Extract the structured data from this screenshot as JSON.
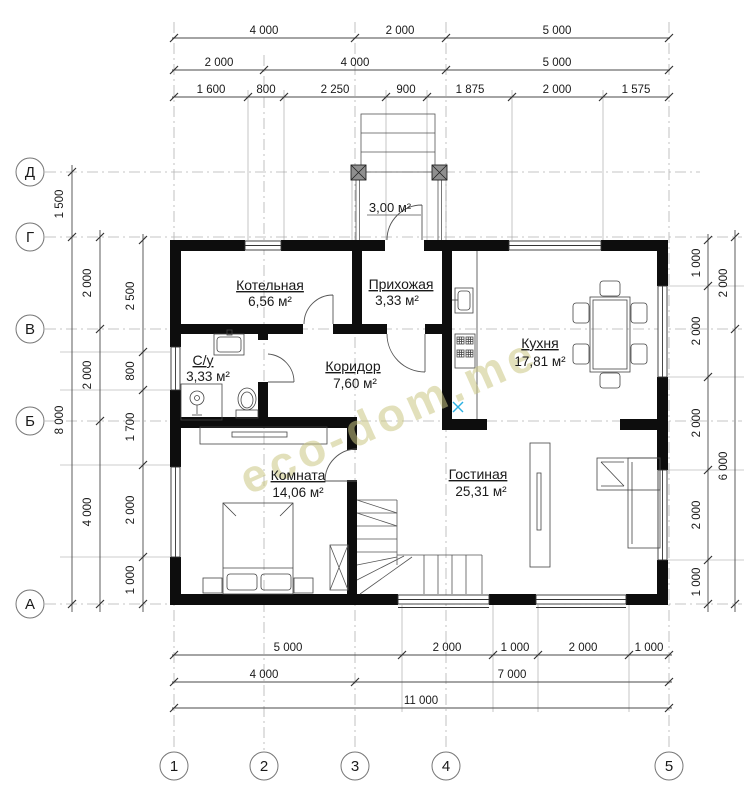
{
  "watermark": {
    "text": "eco-dom.me"
  },
  "axis_labels": {
    "rows": [
      "Д",
      "Г",
      "В",
      "Б",
      "А"
    ],
    "cols": [
      "1",
      "2",
      "3",
      "4",
      "5"
    ]
  },
  "rooms": [
    {
      "name": "Котельная",
      "area": "6,56 м²"
    },
    {
      "name": "Прихожая",
      "area": "3,33 м²"
    },
    {
      "name": "Кухня",
      "area": "17,81 м²"
    },
    {
      "name": "С/у",
      "area": "3,33 м²"
    },
    {
      "name": "Коридор",
      "area": "7,60 м²"
    },
    {
      "name": "Комната",
      "area": "14,06 м²"
    },
    {
      "name": "Гостиная",
      "area": "25,31 м²"
    }
  ],
  "porch": {
    "area": "3,00 м²"
  },
  "dimensions": {
    "top_row1": [
      "4 000",
      "2 000",
      "5 000"
    ],
    "top_row2": [
      "2 000",
      "4 000",
      "5 000"
    ],
    "top_row3": [
      "1 600",
      "800",
      "2 250",
      "900",
      "1 875",
      "2 000",
      "1 575"
    ],
    "bottom_row1": [
      "5 000",
      "2 000",
      "1 000",
      "2 000",
      "1 000"
    ],
    "bottom_row2": [
      "4 000",
      "7 000"
    ],
    "bottom_row3": [
      "11 000"
    ],
    "left_outer": [
      "1 500",
      "8 000"
    ],
    "left_middle": [
      "2 000",
      "2 000",
      "4 000"
    ],
    "left_inner": [
      "2 500",
      "800",
      "1 700",
      "2 000",
      "1 000"
    ],
    "right_inner": [
      "1 000",
      "2 000",
      "2 000",
      "2 000",
      "1 000"
    ],
    "right_outer": [
      "2 000",
      "6 000"
    ]
  }
}
